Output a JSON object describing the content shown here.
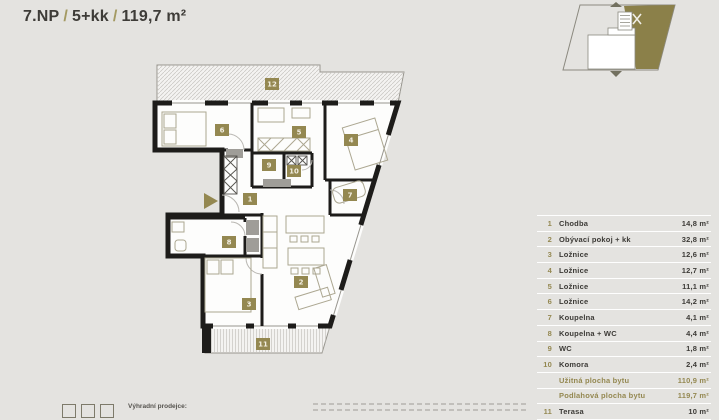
{
  "header": {
    "floor": "7.NP",
    "separator": "/",
    "layout": "5+kk",
    "area": "119,7 m²"
  },
  "minimap": {
    "garden_label": "zahrada"
  },
  "plan": {
    "badges": [
      {
        "n": "12",
        "x": 272,
        "y": 84
      },
      {
        "n": "6",
        "x": 222,
        "y": 130
      },
      {
        "n": "5",
        "x": 299,
        "y": 132
      },
      {
        "n": "4",
        "x": 351,
        "y": 140
      },
      {
        "n": "9",
        "x": 269,
        "y": 165
      },
      {
        "n": "10",
        "x": 294,
        "y": 171
      },
      {
        "n": "1",
        "x": 250,
        "y": 199
      },
      {
        "n": "7",
        "x": 350,
        "y": 195
      },
      {
        "n": "8",
        "x": 229,
        "y": 242
      },
      {
        "n": "2",
        "x": 301,
        "y": 282
      },
      {
        "n": "3",
        "x": 249,
        "y": 304
      },
      {
        "n": "11",
        "x": 263,
        "y": 344
      }
    ]
  },
  "table": {
    "rows": [
      {
        "num": "1",
        "label": "Chodba",
        "value": "14,8 m²"
      },
      {
        "num": "2",
        "label": "Obývací pokoj + kk",
        "value": "32,8 m²"
      },
      {
        "num": "3",
        "label": "Ložnice",
        "value": "12,6 m²"
      },
      {
        "num": "4",
        "label": "Ložnice",
        "value": "12,7 m²"
      },
      {
        "num": "5",
        "label": "Ložnice",
        "value": "11,1 m²"
      },
      {
        "num": "6",
        "label": "Ložnice",
        "value": "14,2 m²"
      },
      {
        "num": "7",
        "label": "Koupelna",
        "value": "4,1 m²"
      },
      {
        "num": "8",
        "label": "Koupelna + WC",
        "value": "4,4 m²"
      },
      {
        "num": "9",
        "label": "WC",
        "value": "1,8 m²"
      },
      {
        "num": "10",
        "label": "Komora",
        "value": "2,4 m²"
      },
      {
        "num": "",
        "label": "Užitná plocha bytu",
        "value": "110,9 m²",
        "summary": true
      },
      {
        "num": "",
        "label": "Podlahová plocha bytu",
        "value": "119,7 m²",
        "summary": true
      },
      {
        "num": "11",
        "label": "Terasa",
        "value": "10 m²"
      }
    ]
  },
  "footer": {
    "dealer_label": "Výhradní prodejce:"
  },
  "colors": {
    "accent_olive": "#948851",
    "minimap_fill": "#8b8049",
    "wall_dark": "#1d1c1a",
    "text_dark": "#3c3a36",
    "background": "#e4e3e0"
  }
}
